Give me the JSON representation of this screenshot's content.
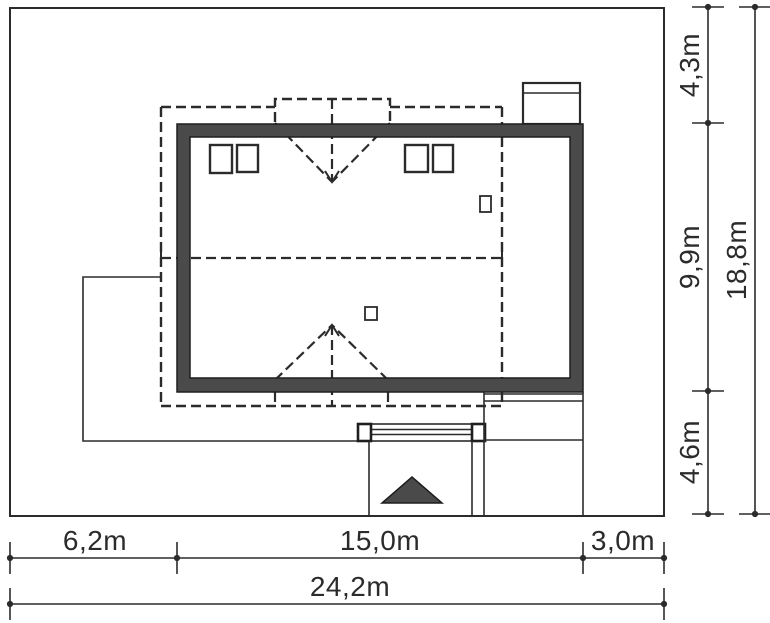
{
  "title": "house-site-plan",
  "colors": {
    "background": "#ffffff",
    "line": "#2b2b2b",
    "wall_fill": "#4a4a4a"
  },
  "dimensions": {
    "bottom": {
      "segments": [
        {
          "label": "6,2m",
          "meters": 6.2
        },
        {
          "label": "15,0m",
          "meters": 15.0
        },
        {
          "label": "3,0m",
          "meters": 3.0
        }
      ],
      "total": {
        "label": "24,2m",
        "meters": 24.2
      }
    },
    "right": {
      "segments": [
        {
          "label": "4,3m",
          "meters": 4.3
        },
        {
          "label": "9,9m",
          "meters": 9.9
        },
        {
          "label": "4,6m",
          "meters": 4.6
        }
      ],
      "total": {
        "label": "18,8m",
        "meters": 18.8
      }
    }
  }
}
